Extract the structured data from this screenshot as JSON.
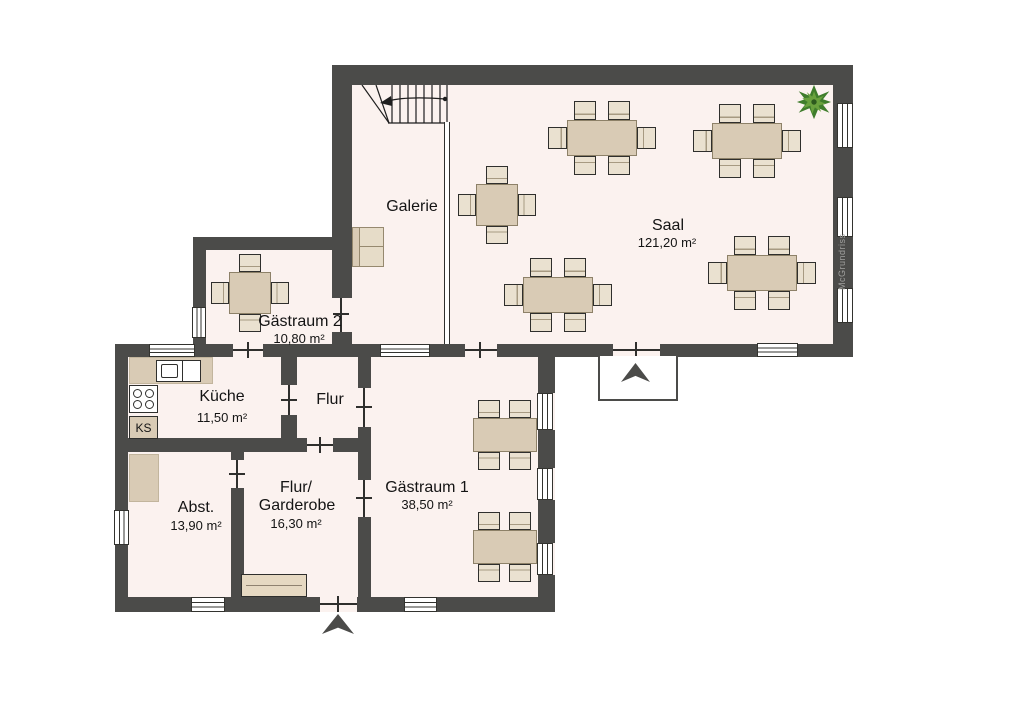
{
  "watermark": "McGrundriss",
  "rooms": {
    "saal": {
      "name": "Saal",
      "area": "121,20 m²"
    },
    "galerie": {
      "name": "Galerie"
    },
    "gaestraum2": {
      "name": "Gästraum 2",
      "area": "10,80 m²"
    },
    "kueche": {
      "name": "Küche",
      "area": "11,50 m²"
    },
    "flur": {
      "name": "Flur"
    },
    "abst": {
      "name": "Abst.",
      "area": "13,90 m²"
    },
    "flur_garderobe": {
      "name_line1": "Flur/",
      "name_line2": "Garderobe",
      "area": "16,30 m²"
    },
    "gaestraum1": {
      "name": "Gästraum 1",
      "area": "38,50 m²"
    }
  },
  "labels": {
    "fridge": "KS"
  },
  "colors": {
    "wall": "#4b4b49",
    "floor": "#fbf2ef",
    "table": "#d9cbb5",
    "chair": "#eae1d0",
    "plant_green": "#4e8f33",
    "watermark_gray": "#a0a09e"
  }
}
